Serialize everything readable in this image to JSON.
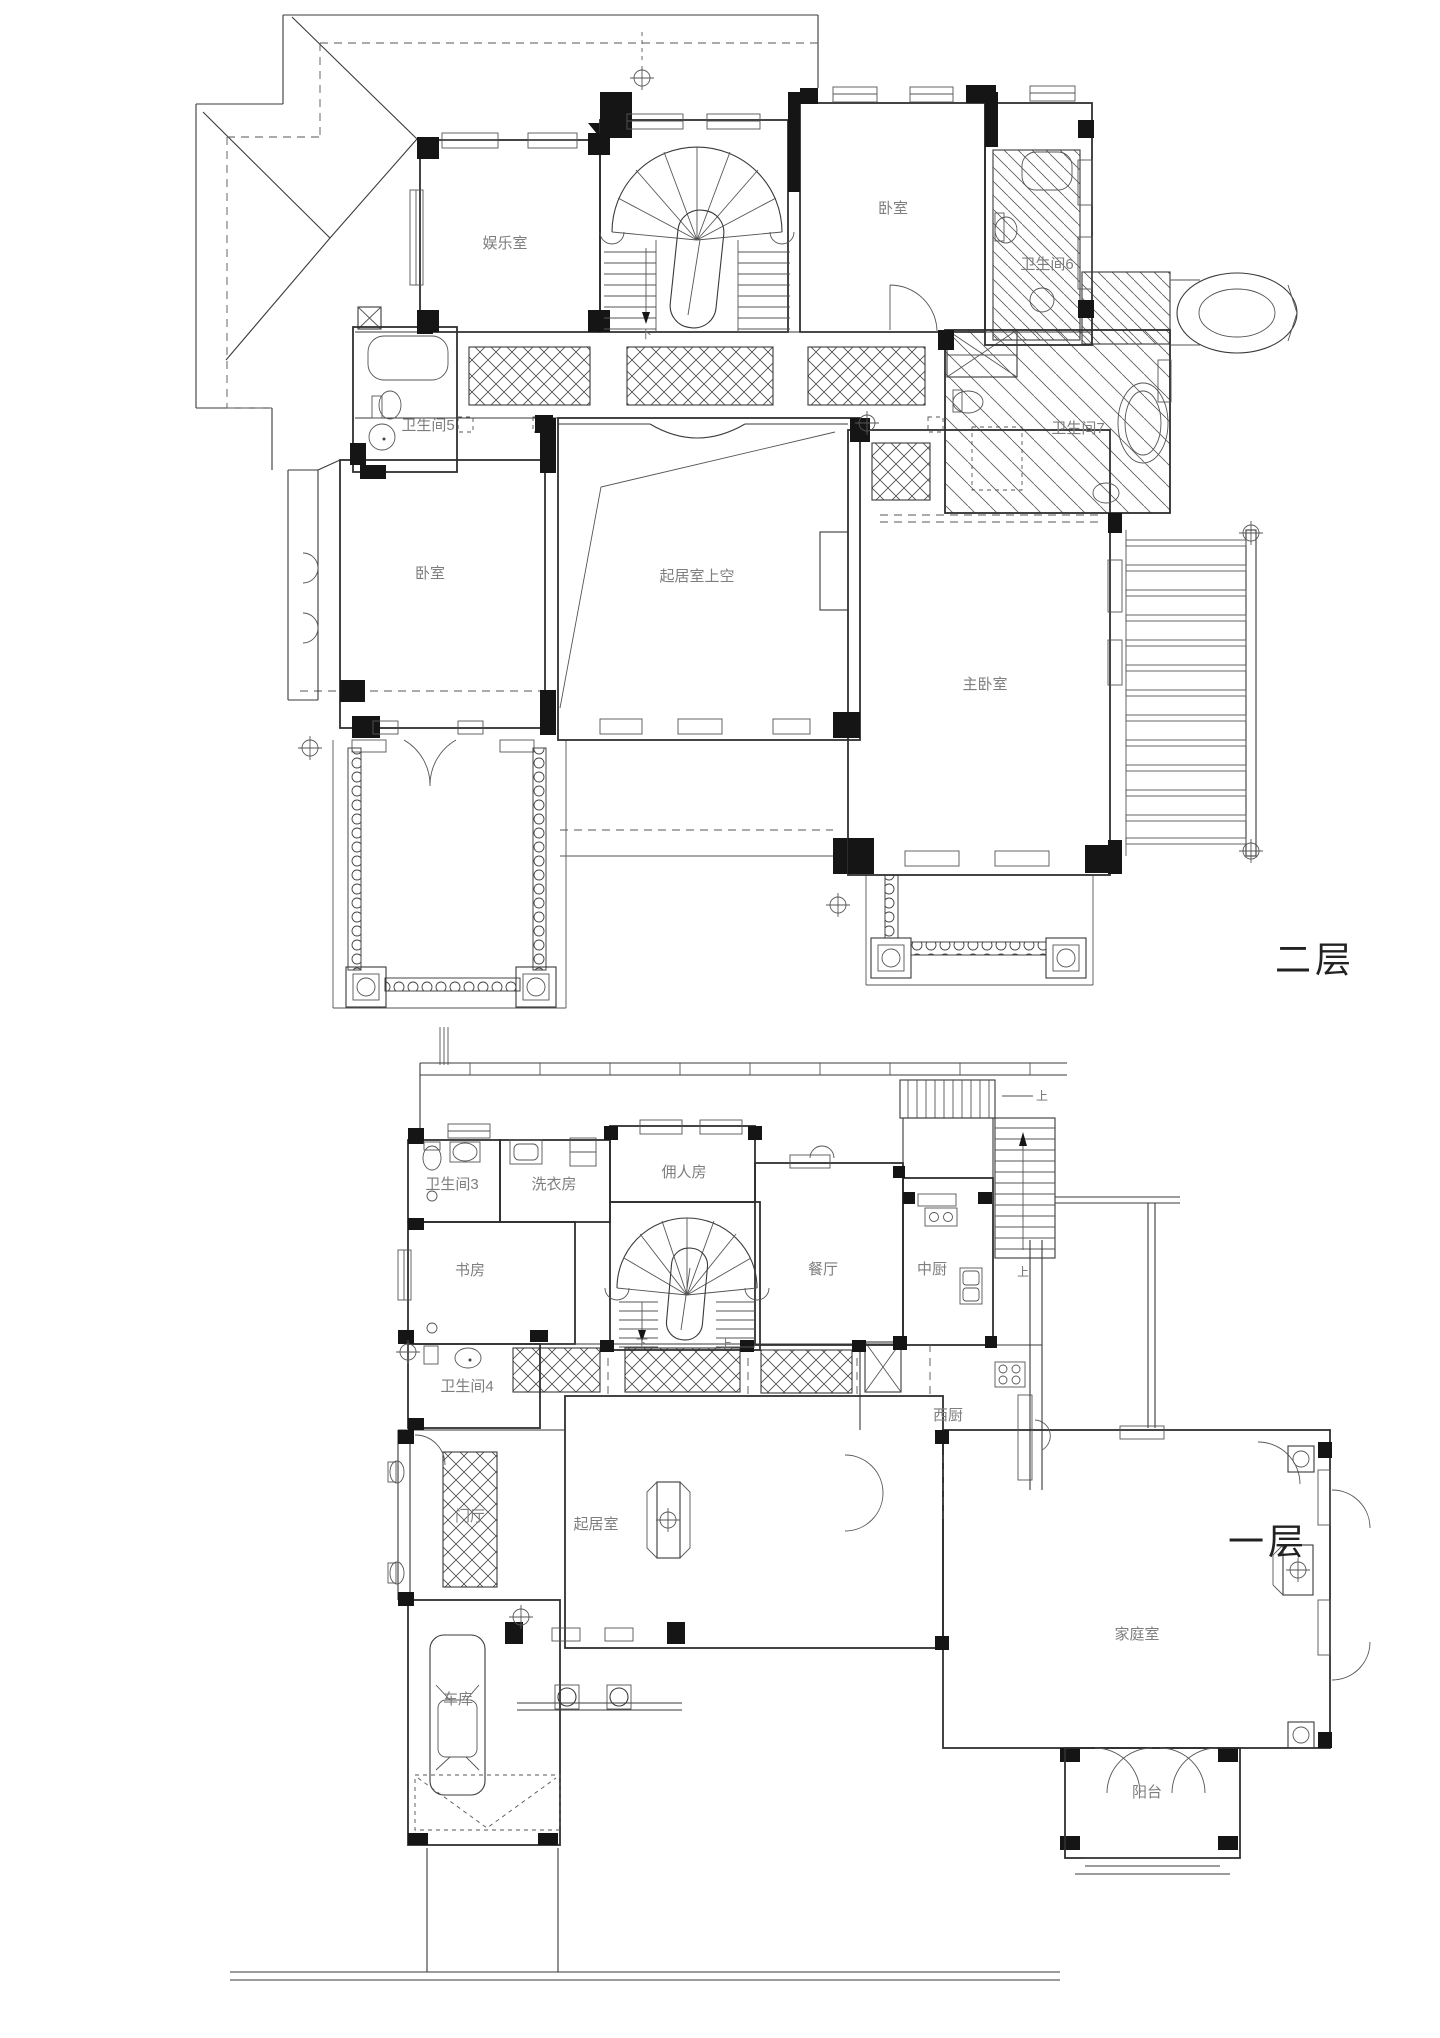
{
  "document": {
    "floors": {
      "second": {
        "name": "二层",
        "rooms": {
          "entertainment": "娱乐室",
          "bedroom_north": "卧室",
          "bath6": "卫生间6",
          "bath5": "卫生间5",
          "bath7": "卫生间7",
          "bedroom_west": "卧室",
          "living_void": "起居室上空",
          "master": "主卧室"
        },
        "stair_down": "下"
      },
      "first": {
        "name": "一层",
        "rooms": {
          "bath3": "卫生间3",
          "laundry": "洗衣房",
          "maid": "佣人房",
          "study": "书房",
          "dining": "餐厅",
          "kitchen_cn": "中厨",
          "bath4": "卫生间4",
          "kitchen_w": "西厨",
          "living": "起居室",
          "foyer": "门厅",
          "family": "家庭室",
          "garage": "车库",
          "balcony": "阳台"
        },
        "stair_down": "下",
        "stair_up": "上",
        "outdoor_stair_up": "上"
      }
    },
    "colors": {
      "line": "#2f2f2f",
      "room_label": "#7e7e7e",
      "floor_label": "#222222",
      "wall_fill": "#151515",
      "background": "#ffffff"
    }
  }
}
